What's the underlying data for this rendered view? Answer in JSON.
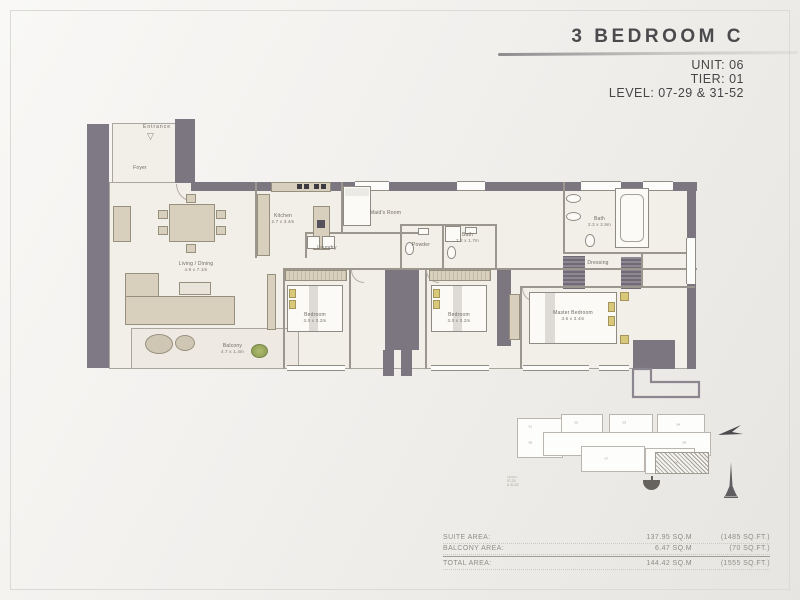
{
  "header": {
    "title": "3 BEDROOM C",
    "unit": "UNIT: 06",
    "tier": "TIER: 01",
    "level": "LEVEL: 07-29 & 31-52"
  },
  "floorplan": {
    "entrance": "Entrance",
    "rooms": [
      {
        "name": "Foyer",
        "dim": ""
      },
      {
        "name": "Living / Dining",
        "dim": "4.9 x 7.1m"
      },
      {
        "name": "Balcony",
        "dim": "4.7 x 1.4m"
      },
      {
        "name": "Kitchen",
        "dim": "2.7 x 3.4m"
      },
      {
        "name": "Maid's Room",
        "dim": ""
      },
      {
        "name": "Laundry",
        "dim": ""
      },
      {
        "name": "Powder",
        "dim": ""
      },
      {
        "name": "Bath",
        "dim": "2.2 x 1.7m"
      },
      {
        "name": "Bath",
        "dim": "2.3 x 2.9m"
      },
      {
        "name": "Dressing",
        "dim": ""
      },
      {
        "name": "Bedroom",
        "dim": "3.0 x 3.2m"
      },
      {
        "name": "Bedroom",
        "dim": "3.0 x 3.2m"
      },
      {
        "name": "Master Bedroom",
        "dim": "3.6 x 3.4m"
      }
    ]
  },
  "key_plan": {
    "unit_labels": {
      "u1": "01",
      "u2": "02",
      "u3": "03",
      "u4": "04",
      "u5": "05",
      "u6": "06",
      "u7": "07",
      "u8": "08"
    },
    "highlighted_unit": "06",
    "note_lines": [
      "LEVEL",
      "07-29",
      "& 31-52"
    ]
  },
  "areas": {
    "rows": [
      {
        "label": "SUITE AREA:",
        "sqm": "137.95 SQ.M",
        "sqft": "(1485 SQ.FT.)"
      },
      {
        "label": "BALCONY AREA:",
        "sqm": "6.47 SQ.M",
        "sqft": "(70 SQ.FT.)"
      }
    ],
    "total": {
      "label": "TOTAL AREA:",
      "sqm": "144.42 SQ.M",
      "sqft": "(1555 SQ.FT.)"
    }
  },
  "icons": {
    "entrance_arrow": "▽"
  },
  "colors": {
    "wall": "#7b7680",
    "paper": "#f2efe9",
    "tan": "#d8cfbd",
    "title_text": "#4b4b4e",
    "table_text": "#8e8e88",
    "pillow": "#d9c87a"
  }
}
